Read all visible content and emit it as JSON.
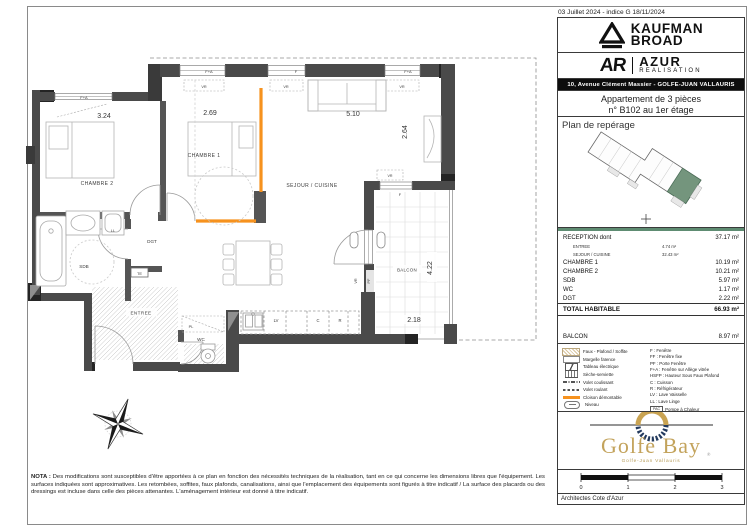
{
  "header": {
    "date": "03 Juillet 2024  - indice G 18/11/2024"
  },
  "brand": {
    "kaufman_line1": "KAUFMAN",
    "kaufman_line2": "BROAD",
    "ar": "AR",
    "azur": "AZUR",
    "realisation": "REALISATION",
    "address": "10, Avenue Clément Massier - GOLFE-JUAN VALLAURIS"
  },
  "apartment": {
    "line1": "Appartement de 3 pièces",
    "line2": "n° B102 au 1er étage"
  },
  "reperage": {
    "title": "Plan de repérage"
  },
  "areas": {
    "rows": [
      {
        "label": "RECEPTION  dont",
        "value": "37.17 m²"
      },
      {
        "label": "ENTREE",
        "value": "4.74 m²"
      },
      {
        "label": "SEJOUR / CUISINE",
        "value": "32.43 m²"
      },
      {
        "label": "CHAMBRE 1",
        "value": "10.19 m²"
      },
      {
        "label": "CHAMBRE 2",
        "value": "10.21 m²"
      },
      {
        "label": "SDB",
        "value": "5.97 m²"
      },
      {
        "label": "WC",
        "value": "1.17 m²"
      },
      {
        "label": "DGT",
        "value": "2.22 m²"
      }
    ],
    "total": {
      "label": "TOTAL HABITABLE",
      "value": "66.93 m²"
    },
    "balcon": {
      "label": "BALCON",
      "value": "8.97 m²"
    }
  },
  "legend": {
    "left": [
      {
        "label": "Faux - Plafond / Soffite"
      },
      {
        "label": "Margelle faïence"
      },
      {
        "label": "Tableau électrique"
      },
      {
        "label": "Sèche-serviette"
      },
      {
        "label": "Volet coulissant"
      },
      {
        "label": "Volet roulant"
      },
      {
        "label": "Cloison démontable"
      },
      {
        "label": "Niveau"
      }
    ],
    "right": [
      "F : Fenêtre",
      "FF : Fenêtre fixe",
      "PF : Porte Fenêtre",
      "F+A : Fenêtre sur Allège vitrée",
      "HSFP : Hauteur Sous Faux Plafond",
      "C : Cuisson",
      "R : Réfrigérateur",
      "LV : Lave Vaisselle",
      "LL : Lave Linge"
    ],
    "pac_box": "PAC",
    "pac_label": "Pompe à Chaleur",
    "colors": {
      "cloison": "#f6921e",
      "accent_green": "#5e8c72"
    }
  },
  "golfe": {
    "name": "Golfe Bay",
    "sub": "Golfe-Juan Vallauris",
    "reg": "®"
  },
  "scalebar": {
    "ticks": [
      "0",
      "1",
      "2",
      "3"
    ]
  },
  "architect": "Architectes Cote d'Azur",
  "nota": {
    "prefix": "NOTA :",
    "body": " Des modifications sont susceptibles d'être apportées à ce plan en fonction des nécessités techniques de la réalisation, tant en ce qui concerne les dimensions libres que l'équipement. Les surfaces indiquées sont approximatives. Les retombées, soffites, faux plafonds, canalisations, ainsi que l'emplacement des équipements sont figurés à titre indicatif / La surface des placards ou des dressings est incluse dans celle des pièces attenantes. L'aménagement intérieur est donné à titre indicatif."
  },
  "plan": {
    "rooms": {
      "chambre2": "CHAMBRE 2",
      "chambre1": "CHAMBRE 1",
      "sejour": "SEJOUR / CUISINE",
      "dgt": "DGT",
      "sdb": "SDB",
      "wc": "WC",
      "entree": "ENTREE",
      "balcon": "BALCON",
      "pl": "PL"
    },
    "dims": {
      "w_ch2": "3.24",
      "w_ch1": "2.69",
      "w_sej": "5.10",
      "d_sej": "2.64",
      "l_balc": "4.22",
      "w_balc": "2.18"
    },
    "labels": {
      "fa": "F+A",
      "f": "F",
      "vr": "VR",
      "pf": "PF",
      "ll": "LL",
      "te": "TE",
      "lv": "LV",
      "c": "C",
      "r": "R"
    }
  }
}
